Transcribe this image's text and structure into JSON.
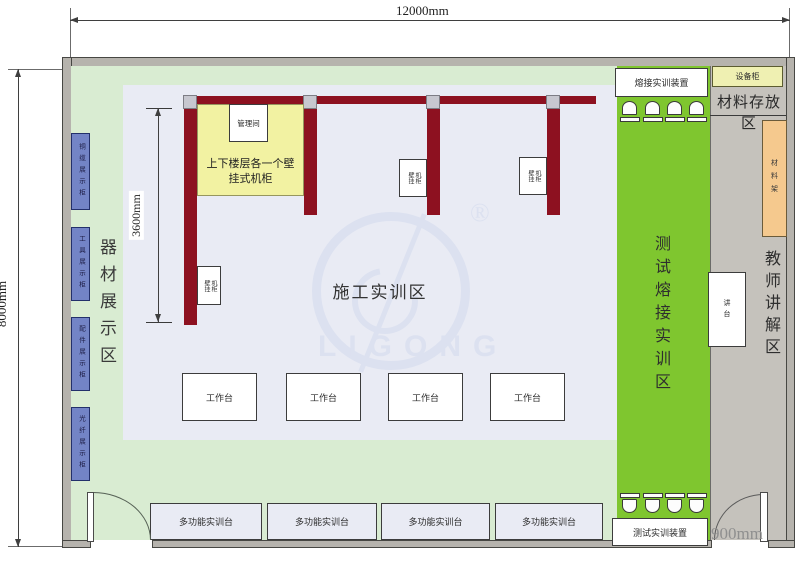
{
  "dimensions": {
    "top": "12000mm",
    "left": "8000mm",
    "inner": "3600mm",
    "door": "900mm"
  },
  "areas": {
    "equipment_display": "器材展示区",
    "construction": "施工实训区",
    "test_splice": "测试熔接实训区",
    "material_storage": "材料存放区",
    "teacher_zone": "教师讲解区"
  },
  "display_cabinets": [
    "铜缆展示柜",
    "工具展示柜",
    "配件展示柜",
    "光纤展示柜"
  ],
  "note_box": {
    "line1": "上下楼层各一个壁",
    "line2": "挂式机柜"
  },
  "management_room": "管理间",
  "wall_cabinets": [
    {
      "c1": "壁挂",
      "c2": "机柜"
    },
    {
      "c1": "壁挂",
      "c2": "机柜"
    },
    {
      "c1": "壁挂",
      "c2": "机柜"
    }
  ],
  "equipment": {
    "splice_device": "熔接实训装置",
    "test_device": "测试实训装置",
    "equipment_cabinet": "设备柜",
    "material_rack": "材料架",
    "podium": "讲台"
  },
  "workbenches": [
    "工作台",
    "工作台",
    "工作台",
    "工作台"
  ],
  "multi_benches": [
    "多功能实训台",
    "多功能实训台",
    "多功能实训台",
    "多功能实训台"
  ],
  "watermark": {
    "brand": "LIGONG",
    "registered": "®"
  },
  "colors": {
    "bright_green": "#7fc62f",
    "pale_green": "#d9ecd2",
    "main_floor": "#e9ebf4",
    "gray_floor": "#c5c2bc",
    "wall_red": "#8d1120",
    "cabinet_blue": "#7384c6",
    "note_yellow": "#f2f2a2",
    "rack_orange": "#f5c98e"
  }
}
